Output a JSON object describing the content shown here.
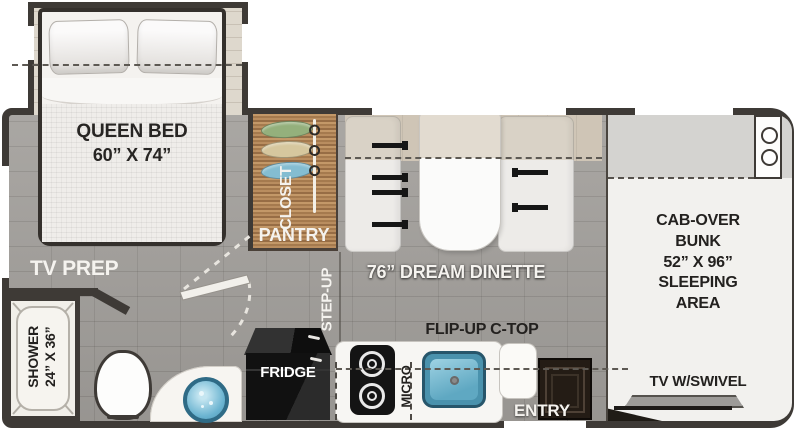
{
  "labels": {
    "queen_bed": {
      "line1": "QUEEN BED",
      "line2": "60” X 74”"
    },
    "tv_prep": "TV PREP",
    "closet": "CLOSET",
    "pantry": "PANTRY",
    "step_up": "STEP-UP",
    "dinette": "76” DREAM DINETTE",
    "cab_over": {
      "l1": "CAB-OVER",
      "l2": "BUNK",
      "l3": "52” X 96”",
      "l4": "SLEEPING",
      "l5": "AREA"
    },
    "shower": {
      "line1": "SHOWER",
      "line2": "24” X 36”"
    },
    "fridge": "FRIDGE",
    "micro": "MICRO",
    "flip_up": "FLIP-UP C-TOP",
    "entry": "ENTRY",
    "tv_swivel": "TV W/SWIVEL"
  },
  "colors": {
    "wall": "#3e3a36",
    "floor_main": "#a3a09c",
    "floor_bedroom": "#ded8cd",
    "wood": "#ad8257",
    "slide_band": "#cfc5b6",
    "sink_blue": "#5fa8c2",
    "accent_white": "#f5f3ef"
  }
}
